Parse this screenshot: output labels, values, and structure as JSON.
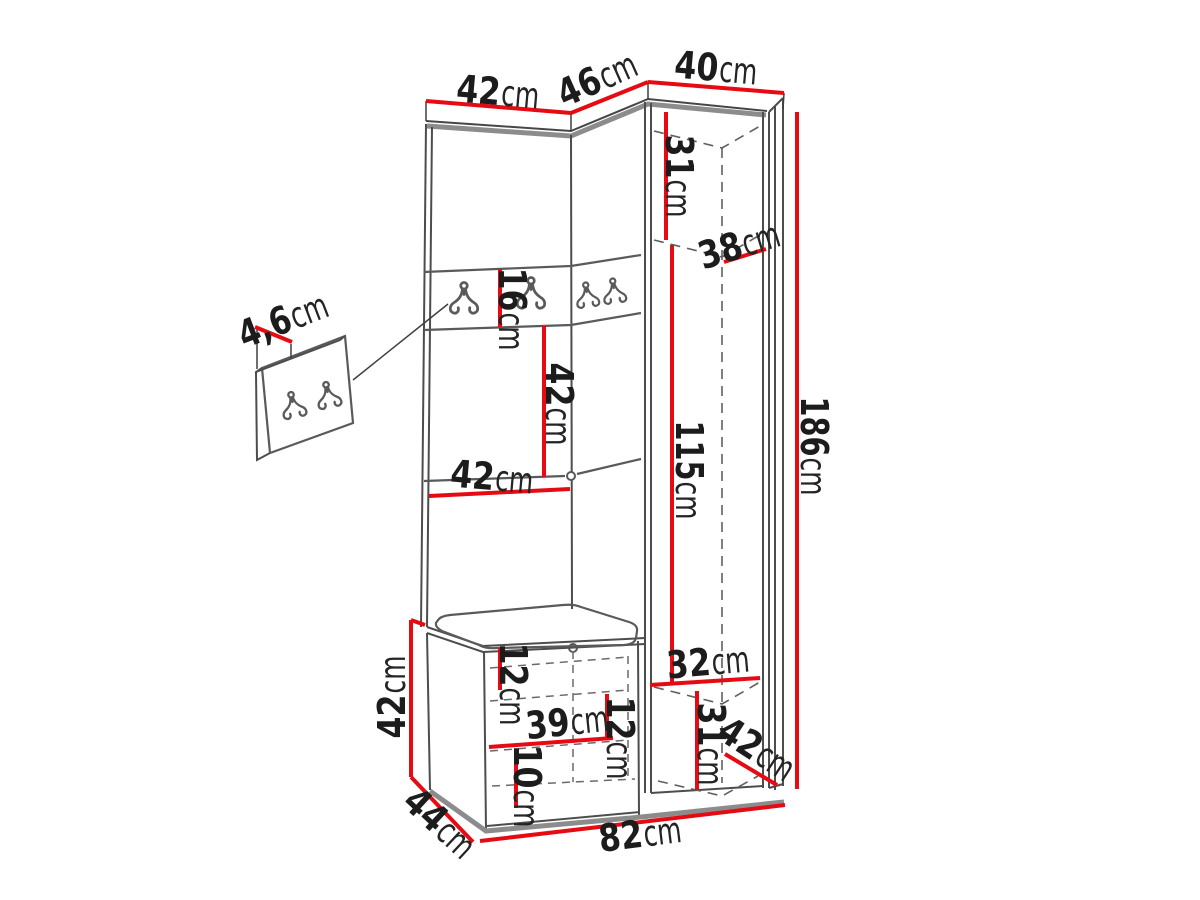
{
  "figure": {
    "type": "furniture-dimension-diagram",
    "description": "Hallway wardrobe set with coat hooks, corner cabinet, hook panel detail and shoe bench, annotated with dimension lines"
  },
  "colors": {
    "dimension_line": "#e60b12",
    "outline_dark": "#4a4a4a",
    "outline_light": "#8c8c8c",
    "label_text": "#1c1c1c",
    "background": "#ffffff"
  },
  "dimensions": {
    "top_left_width": {
      "value": "42",
      "unit": "cm"
    },
    "top_angled_width": {
      "value": "46",
      "unit": "cm"
    },
    "top_right_width": {
      "value": "40",
      "unit": "cm"
    },
    "upper_cabinet_inner_height": {
      "value": "31",
      "unit": "cm"
    },
    "upper_shelf_depth": {
      "value": "38",
      "unit": "cm"
    },
    "hook_rail_height": {
      "value": "16",
      "unit": "cm"
    },
    "mid_section_height": {
      "value": "42",
      "unit": "cm"
    },
    "mid_section_width": {
      "value": "42",
      "unit": "cm"
    },
    "wardrobe_inner_height": {
      "value": "115",
      "unit": "cm"
    },
    "total_height": {
      "value": "186",
      "unit": "cm"
    },
    "hook_panel_thickness": {
      "value": "4,6",
      "unit": "cm"
    },
    "bench_height": {
      "value": "42",
      "unit": "cm"
    },
    "bench_depth": {
      "value": "44",
      "unit": "cm"
    },
    "bench_top_clearance": {
      "value": "12",
      "unit": "cm"
    },
    "bench_shelf_width": {
      "value": "39",
      "unit": "cm"
    },
    "bench_mid_clearance": {
      "value": "12",
      "unit": "cm"
    },
    "bench_bottom_clearance": {
      "value": "10",
      "unit": "cm"
    },
    "lower_inner_width": {
      "value": "32",
      "unit": "cm"
    },
    "lower_inner_height": {
      "value": "31",
      "unit": "cm"
    },
    "lower_cabinet_depth": {
      "value": "42",
      "unit": "cm"
    },
    "total_width": {
      "value": "82",
      "unit": "cm"
    }
  }
}
